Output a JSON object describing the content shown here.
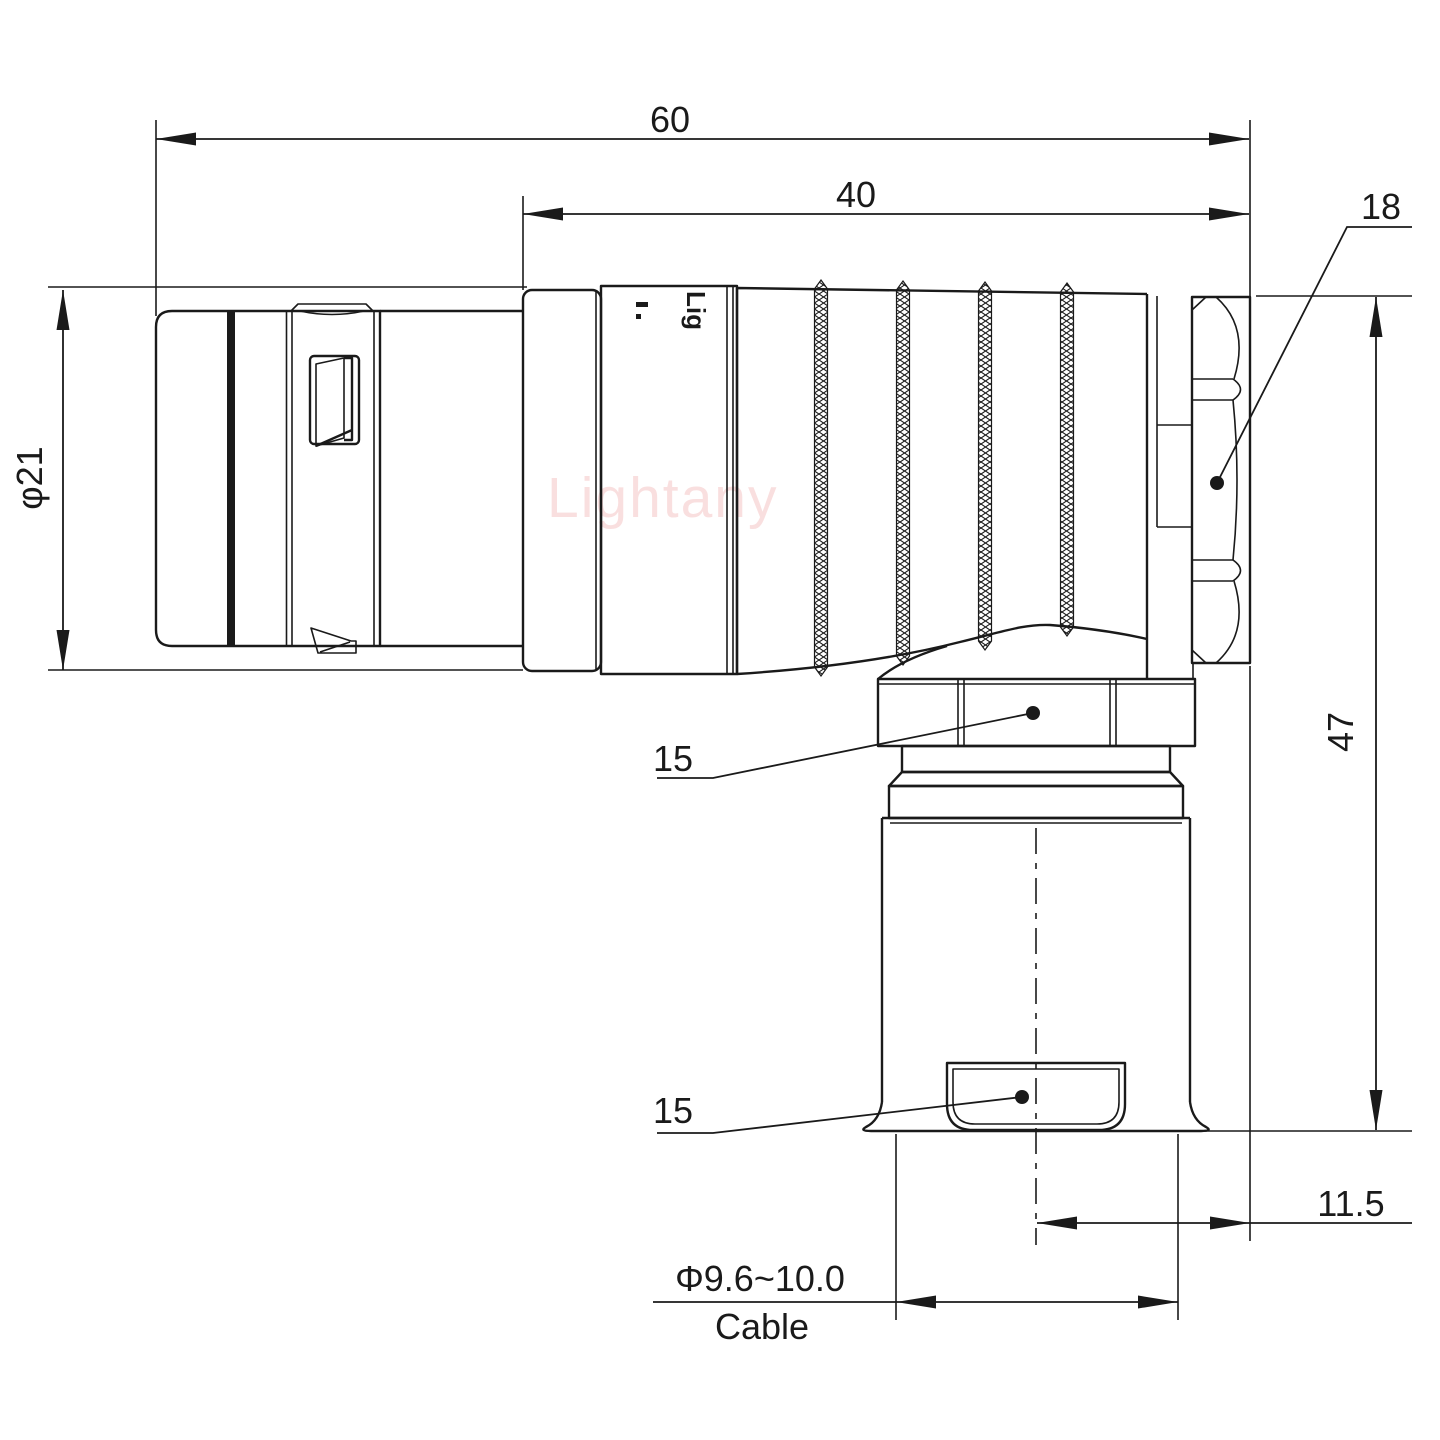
{
  "drawing": {
    "type": "engineering-drawing",
    "subject": "right-angle circular push-pull connector, side elevation with dimensions",
    "units": "mm",
    "watermark_text": "Lightany",
    "body_stamp_text": "Lig",
    "colors": {
      "line": "#1a1a1a",
      "background": "#ffffff",
      "watermark": "#f5c6c6"
    },
    "dimensions": {
      "overall_length": {
        "label": "60"
      },
      "front_length": {
        "label": "40"
      },
      "rear_nut_leader": {
        "label": "18"
      },
      "body_diameter": {
        "label": "φ21"
      },
      "overall_height": {
        "label": "47"
      },
      "coupling_nut_leader": {
        "label": "15"
      },
      "cable_clamp_leader": {
        "label": "15"
      },
      "axis_offset": {
        "label": "11.5"
      },
      "cable_diameter": {
        "label": "Φ9.6~10.0"
      },
      "cable_caption": {
        "label": "Cable"
      }
    }
  }
}
